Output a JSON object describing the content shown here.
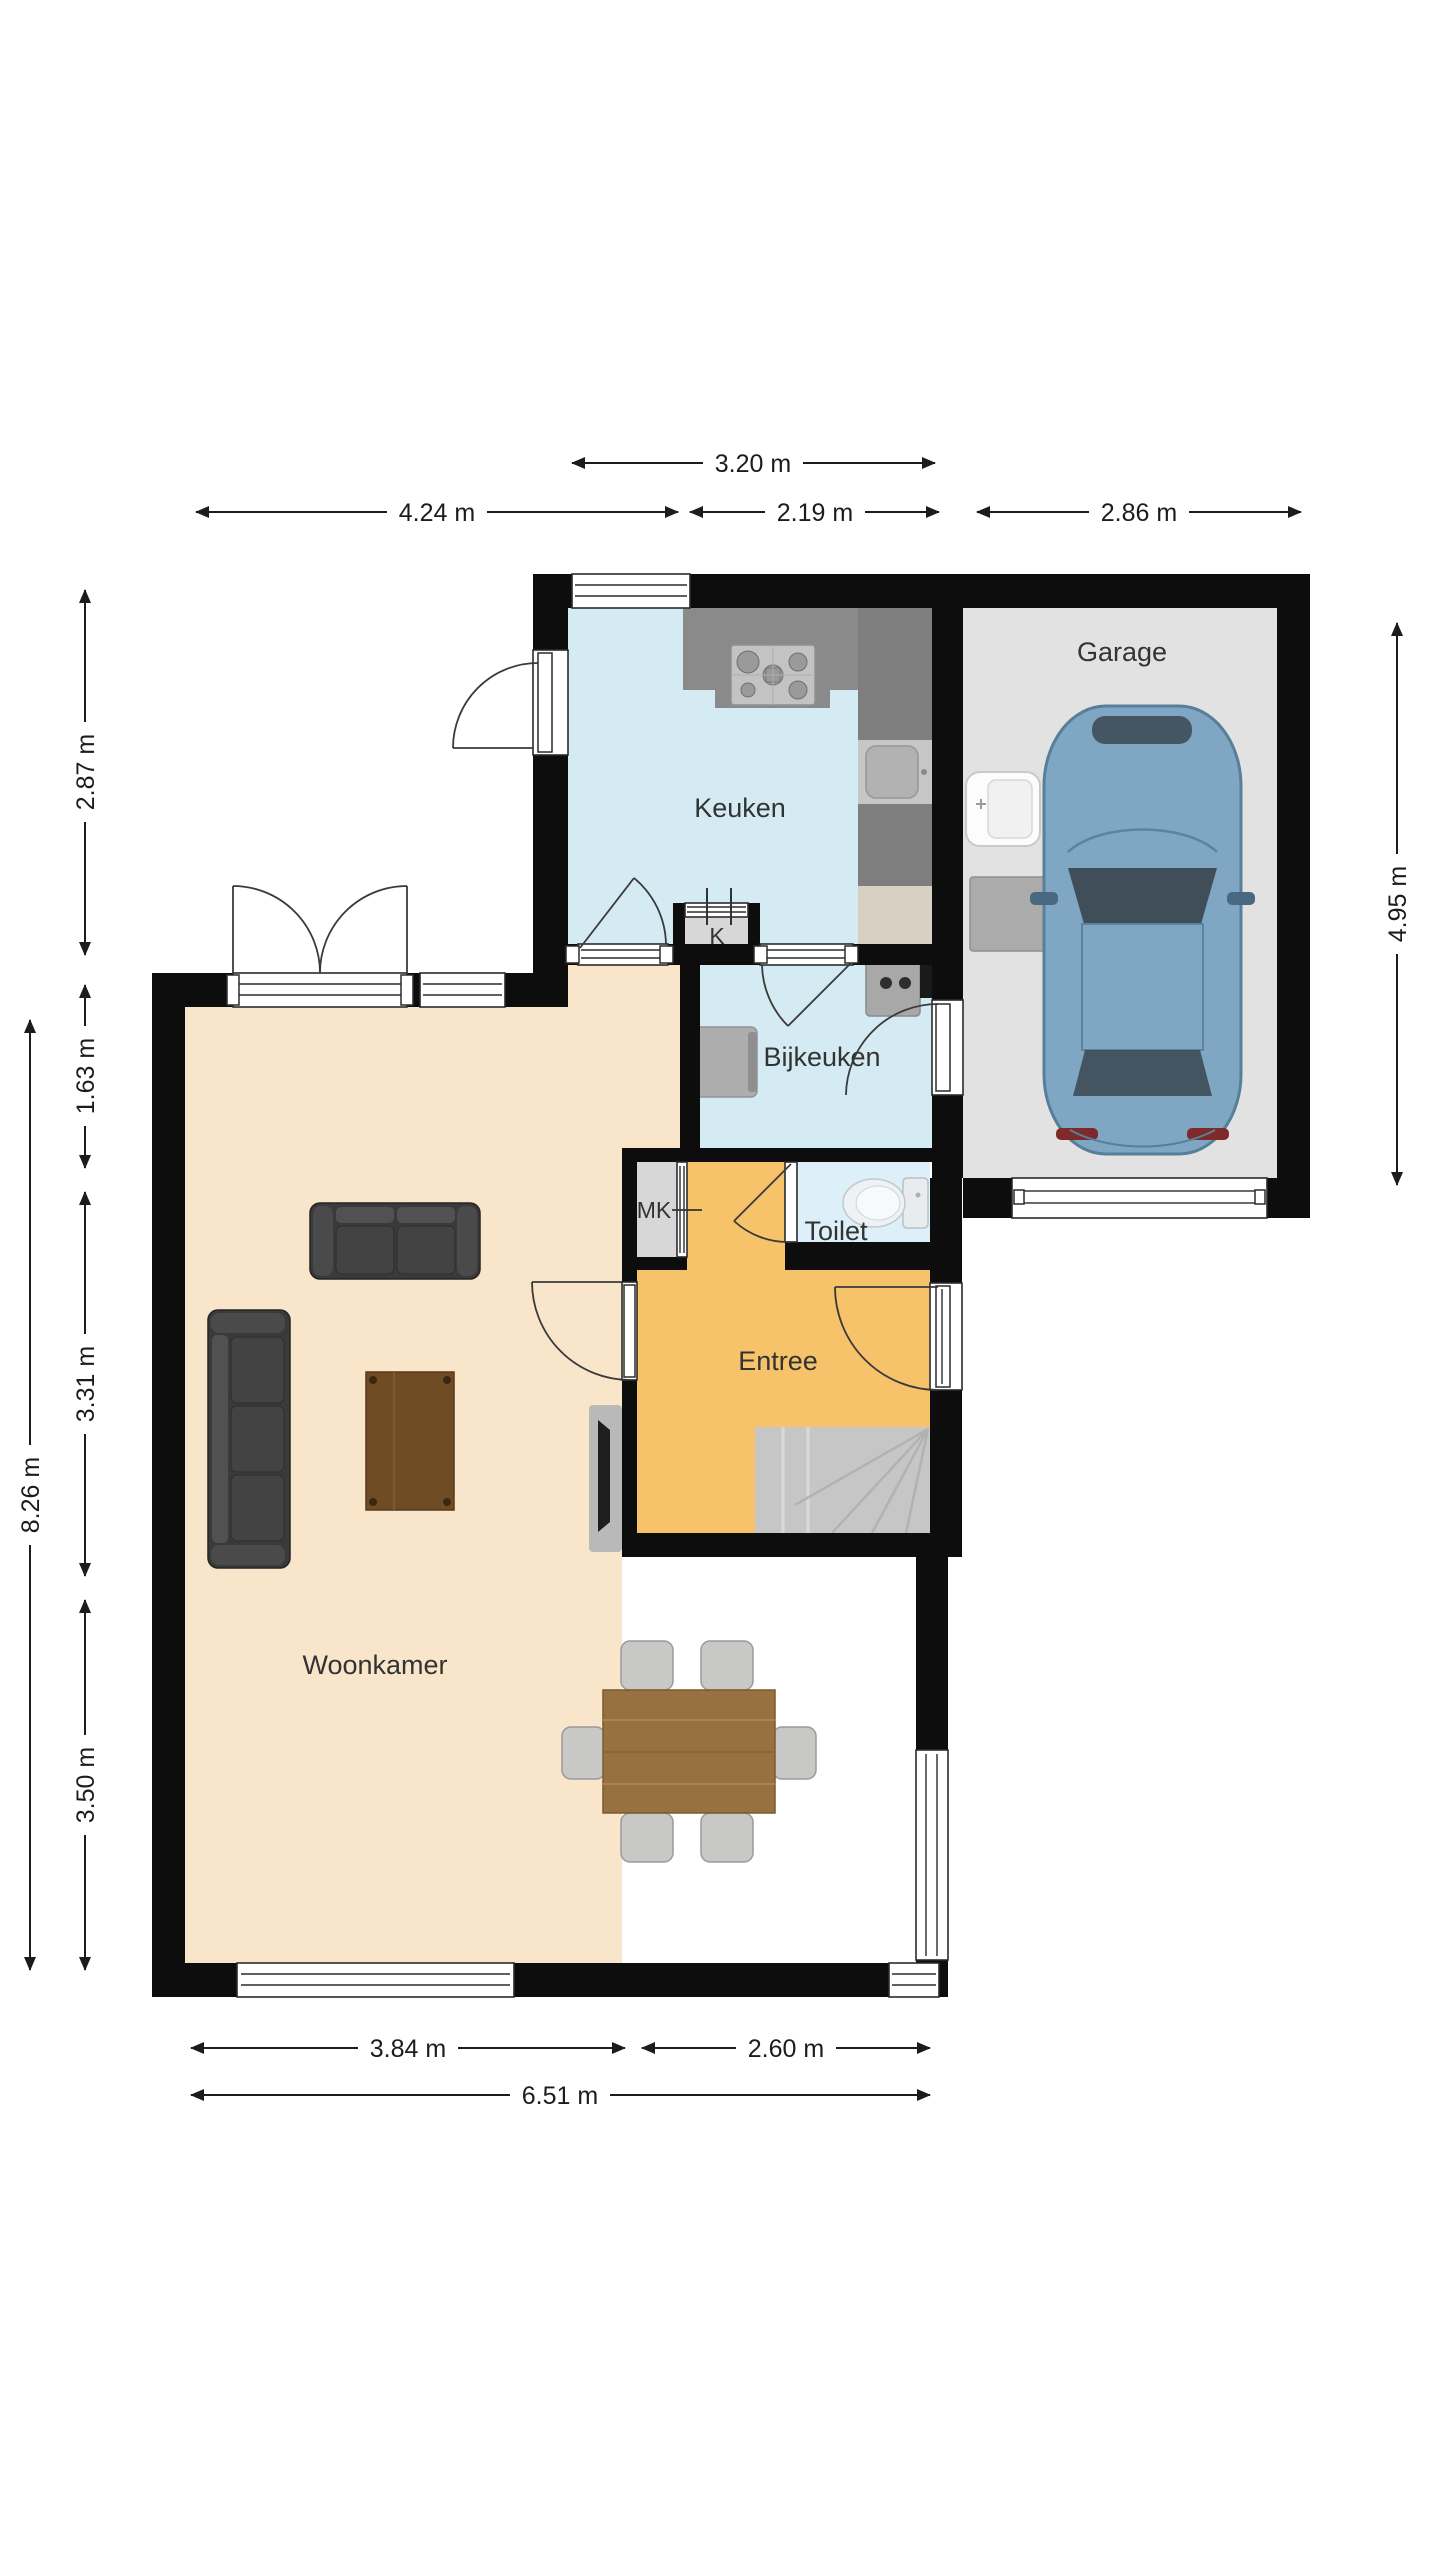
{
  "plan": {
    "rooms": {
      "keuken": "Keuken",
      "garage": "Garage",
      "bijkeuken": "Bijkeuken",
      "toilet": "Toilet",
      "entree": "Entree",
      "woonkamer": "Woonkamer",
      "mk": "MK",
      "k": "K"
    },
    "dimensions": {
      "top_320": "3.20 m",
      "top_424": "4.24 m",
      "top_219": "2.19 m",
      "top_286": "2.86 m",
      "left_287": "2.87 m",
      "left_163": "1.63 m",
      "left_331": "3.31 m",
      "left_350": "3.50 m",
      "left_826": "8.26 m",
      "right_495": "4.95 m",
      "bottom_384": "3.84 m",
      "bottom_260": "2.60 m",
      "bottom_651": "6.51 m"
    },
    "colors": {
      "wall": "#0d0d0d",
      "kitchen_floor": "#d5ebf4",
      "toilet_floor": "#ddeff8",
      "entree_floor": "#f6c36a",
      "woonkamer_floor": "#f9e5c9",
      "garage_floor": "#e2e2e2",
      "closet_floor": "#d7d7d7",
      "counter_dark": "#8a8a8a",
      "counter_beige": "#d8d0c2",
      "stairs": "#c6c6c6",
      "car_body": "#7fa7c3"
    }
  }
}
